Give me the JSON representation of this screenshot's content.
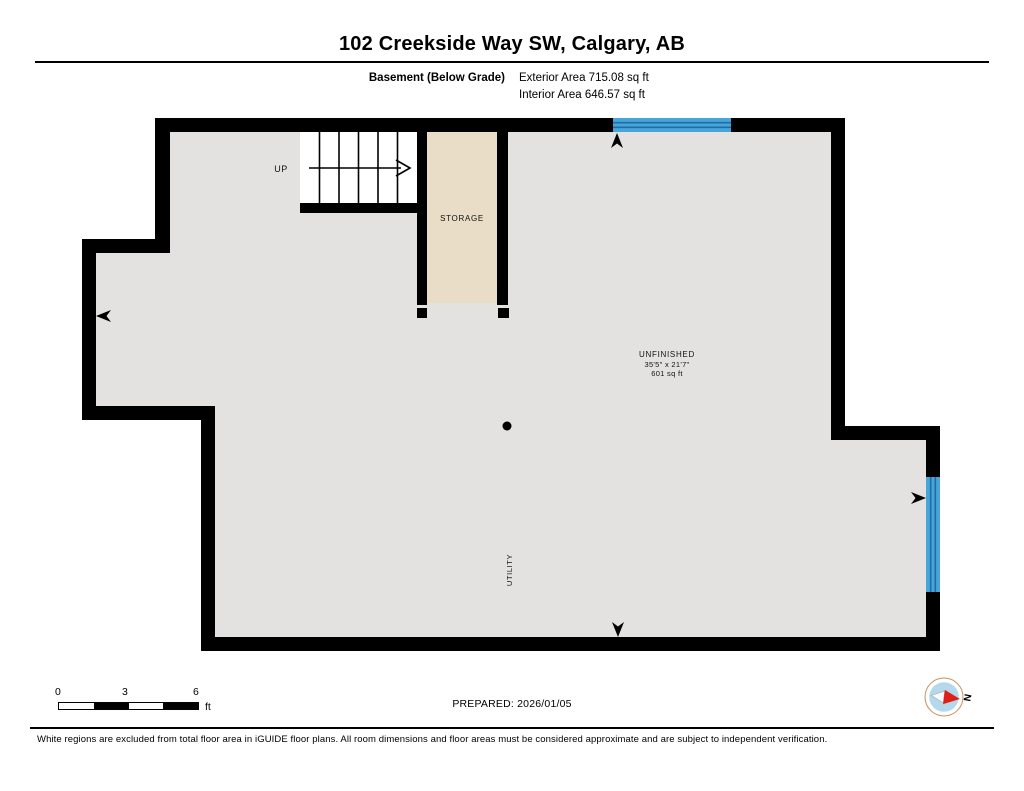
{
  "header": {
    "title": "102 Creekside Way SW, Calgary, AB",
    "floor_label": "Basement (Below Grade)",
    "exterior_area": "Exterior Area 715.08 sq ft",
    "interior_area": "Interior Area 646.57 sq ft"
  },
  "plan": {
    "stairs_label": "UP",
    "rooms": [
      {
        "name": "STORAGE"
      },
      {
        "name": "UNFINISHED",
        "dimensions": "35'5\" x 21'7\"",
        "area": "601 sq ft"
      },
      {
        "name": "UTILITY"
      }
    ],
    "colors": {
      "wall": "#000000",
      "interior": "#e3e2e1",
      "storage_fill": "#e9ddc8",
      "window": "#47a5d8",
      "window_line": "#1e6da4"
    }
  },
  "footer": {
    "scale_ticks": [
      "0",
      "3",
      "6"
    ],
    "scale_unit": "ft",
    "prepared": "PREPARED: 2026/01/05",
    "compass_label": "N",
    "disclaimer": "White regions are excluded from total floor area in iGUIDE floor plans. All room dimensions and floor areas must be considered approximate and are subject to independent verification."
  }
}
